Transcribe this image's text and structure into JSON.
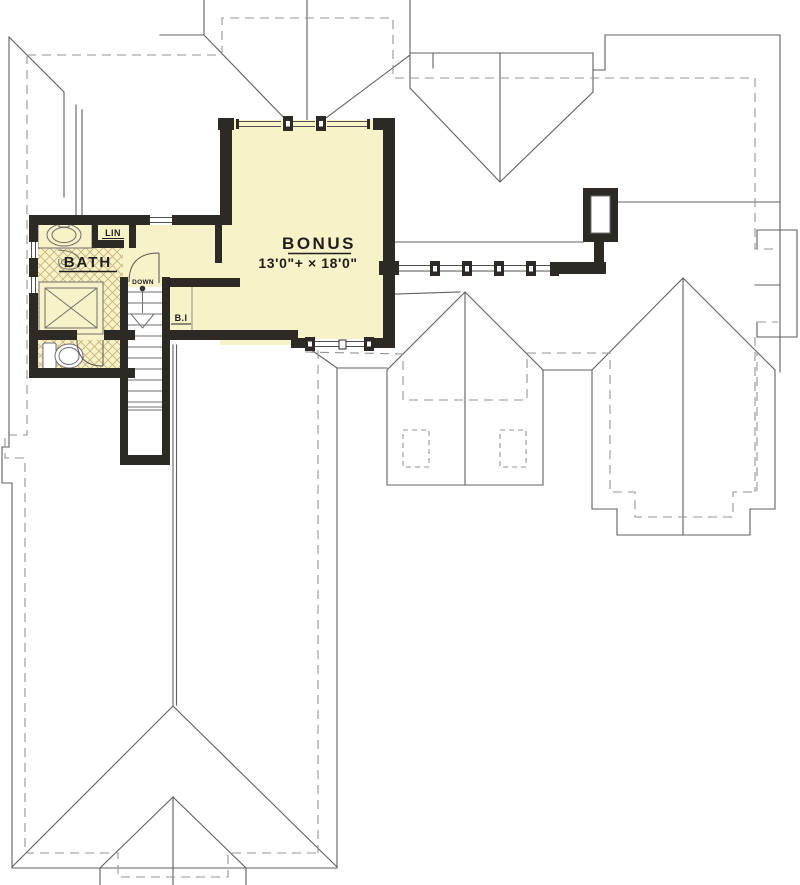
{
  "plan": {
    "rooms": {
      "bonus": {
        "label": "BONUS",
        "dims": "13'0\"+ × 18'0\""
      },
      "bath": {
        "label": "BATH"
      },
      "linen_closet": {
        "label": "LIN"
      },
      "built_in": {
        "label": "B.I"
      },
      "stairs": {
        "label": "DOWN"
      }
    },
    "colors": {
      "floor_fill": "#f7f2c8",
      "wall": "#2d2a25",
      "tile_hatch": "#c9b27c",
      "roof_line": "#5f5f5f",
      "eave_dash": "#939393",
      "background": "#ffffff"
    },
    "fixtures": [
      "sink-vanity",
      "shower",
      "toilet",
      "linen-closet",
      "stair-treads",
      "chimney",
      "window-band"
    ]
  }
}
